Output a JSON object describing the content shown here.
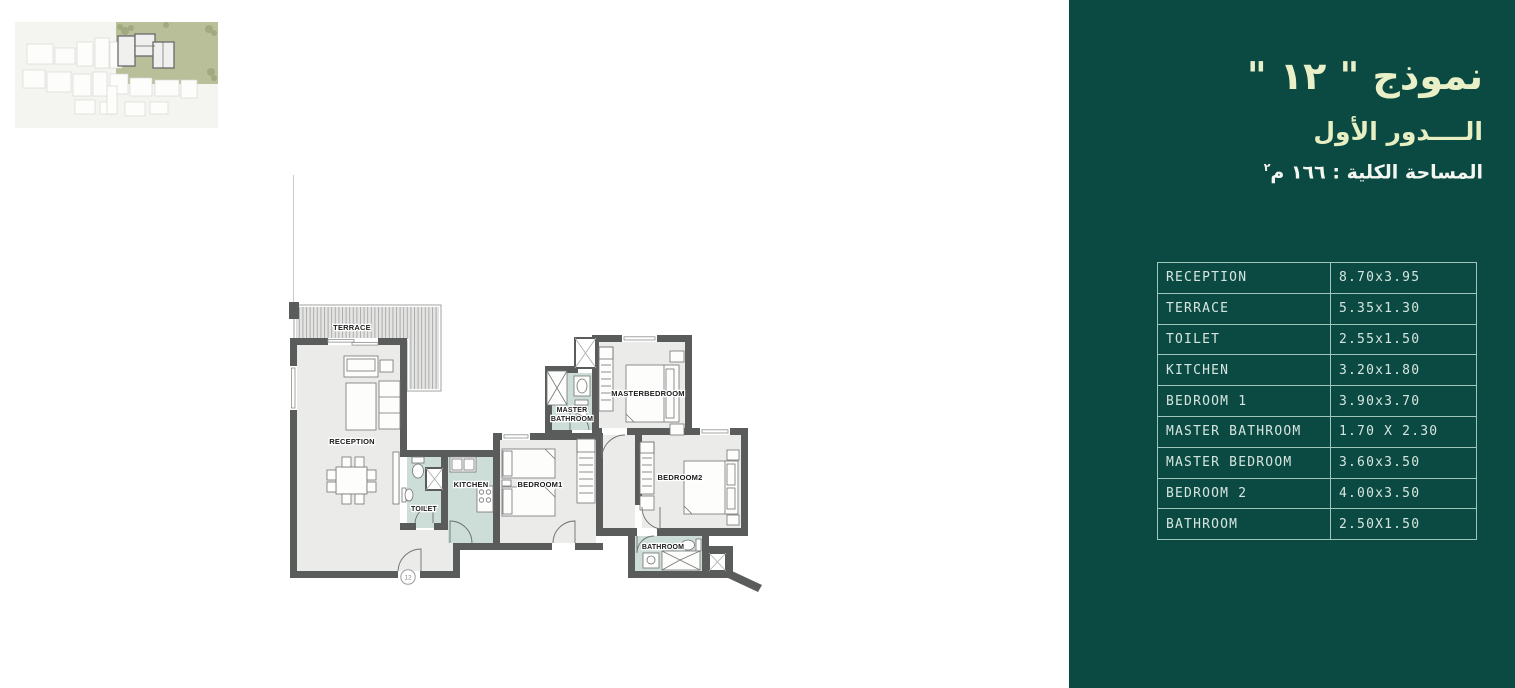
{
  "colors": {
    "panel_bg": "#0b4a43",
    "title_color": "#e9efc6",
    "area_color": "#f4f6f0",
    "table_line": "#9fc5bc",
    "table_text": "#d6e5df",
    "wall": "#5a5b5b",
    "floor": "#ebecea",
    "wet_floor": "#cdddd7",
    "terrace_hatch": "#a5a6a5",
    "site_green": "#b8bf99"
  },
  "panel": {
    "title": "نموذج \" ١٢ \"",
    "subtitle": "الــــدور الأول",
    "area_text": "المساحة الكلية : ١٦٦ م",
    "area_sup": "٢",
    "table": {
      "rows": [
        {
          "name": "RECEPTION",
          "dims": "8.70x3.95"
        },
        {
          "name": "TERRACE",
          "dims": "5.35x1.30"
        },
        {
          "name": "TOILET",
          "dims": "2.55x1.50"
        },
        {
          "name": "KITCHEN",
          "dims": "3.20x1.80"
        },
        {
          "name": "BEDROOM 1",
          "dims": "3.90x3.70"
        },
        {
          "name": "MASTER BATHROOM",
          "dims": "1.70 X 2.30"
        },
        {
          "name": "MASTER BEDROOM",
          "dims": "3.60x3.50"
        },
        {
          "name": "BEDROOM 2",
          "dims": "4.00x3.50"
        },
        {
          "name": "BATHROOM",
          "dims": "2.50X1.50"
        }
      ]
    }
  },
  "floor_plan": {
    "labels": {
      "terrace": "TERRACE",
      "reception": "RECEPTION",
      "toilet": "TOILET",
      "kitchen": "KITCHEN",
      "bedroom1": "BEDROOM1",
      "master_line1": "MASTER",
      "master_line2": "BATHROOM",
      "masterbedroom": "MASTERBEDROOM",
      "bedroom2": "BEDROOM2",
      "bathroom": "BATHROOM"
    },
    "unit_number": "12"
  }
}
